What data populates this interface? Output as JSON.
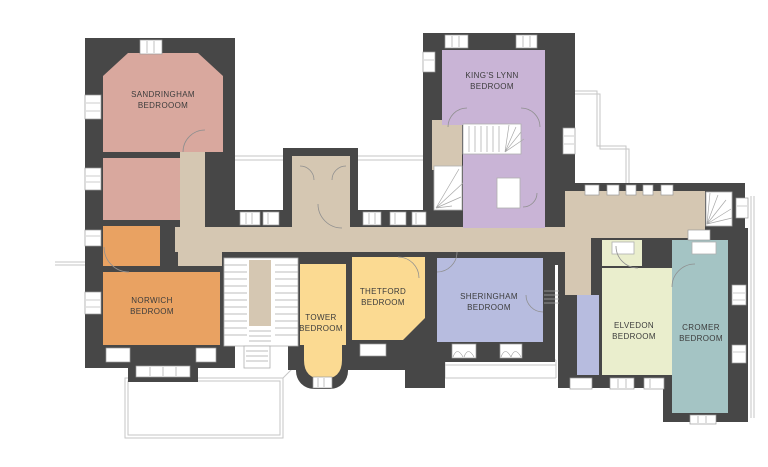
{
  "floorplan": {
    "wall_color": "#474747",
    "corridor_color": "#d5c7b2",
    "label_color": "#3c3c3c",
    "rooms": [
      {
        "id": "sandringham",
        "label_line1": "SANDRINGHAM",
        "label_line2": "BEDROOOM",
        "color": "#d9a89e"
      },
      {
        "id": "kings-lynn",
        "label_line1": "KING'S LYNN",
        "label_line2": "BEDROOM",
        "color": "#c9b4d6"
      },
      {
        "id": "norwich",
        "label_line1": "NORWICH",
        "label_line2": "BEDROOM",
        "color": "#e9a262"
      },
      {
        "id": "tower",
        "label_line1": "TOWER",
        "label_line2": "BEDROOM",
        "color": "#fbda92"
      },
      {
        "id": "thetford",
        "label_line1": "THETFORD",
        "label_line2": "BEDROOM",
        "color": "#fbda92"
      },
      {
        "id": "sheringham",
        "label_line1": "SHERINGHAM",
        "label_line2": "BEDROOM",
        "color": "#b7bcdf"
      },
      {
        "id": "elvedon",
        "label_line1": "ELVEDON",
        "label_line2": "BEDROOM",
        "color": "#eaeecd"
      },
      {
        "id": "cromer",
        "label_line1": "CROMER",
        "label_line2": "BEDROOM",
        "color": "#a4c4c4"
      }
    ]
  }
}
